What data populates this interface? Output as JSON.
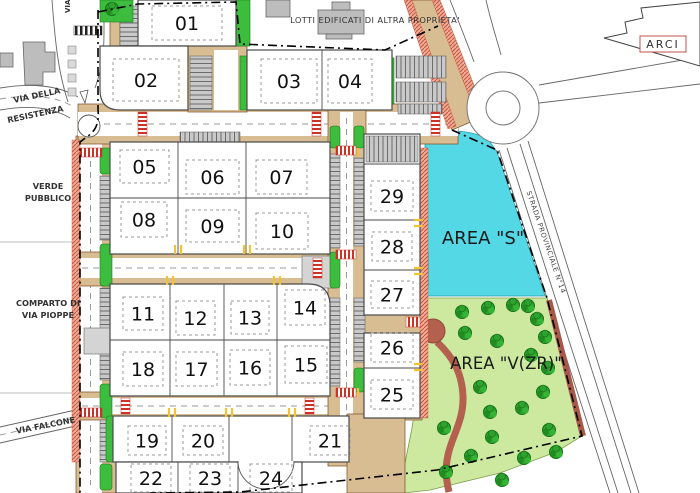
{
  "map": {
    "title_note": "LOTTI EDIFICATI DI ALTRA PROPRIETA'",
    "streets": {
      "via_top": "VIA",
      "via_della": "VIA DELLA",
      "resistenza": "RESISTENZA",
      "verde_1": "VERDE",
      "verde_2": "PUBBLICO",
      "comparto_1": "COMPARTO DI",
      "comparto_2": "VIA PIOPPE",
      "via_falcone": "VIA FALCONE",
      "strada_provinciale": "STRADA PROVINCIALE N°14"
    },
    "areas": {
      "area_s": "AREA \"S\"",
      "area_vzr": "AREA \"V(ZR)\"",
      "arci": "ARCI"
    },
    "lots": [
      "01",
      "02",
      "03",
      "04",
      "05",
      "06",
      "07",
      "08",
      "09",
      "10",
      "11",
      "12",
      "13",
      "14",
      "15",
      "16",
      "17",
      "18",
      "19",
      "20",
      "21",
      "22",
      "23",
      "24",
      "25",
      "26",
      "27",
      "28",
      "29"
    ],
    "colors": {
      "area_s_cyan": "#55d8e6",
      "park_green": "#cde9a0",
      "tree_green": "#2ea22e",
      "road_tan": "#d8bd93",
      "sidewalk_salmon": "#f0ab97",
      "parking_gray": "#c9c9c9",
      "strip_green": "#3dbd3d",
      "crosswalk_red": "#cc3328",
      "path_brick": "#b4604e",
      "building_gray": "#bdbdbd",
      "boundary_black": "#000000"
    }
  }
}
